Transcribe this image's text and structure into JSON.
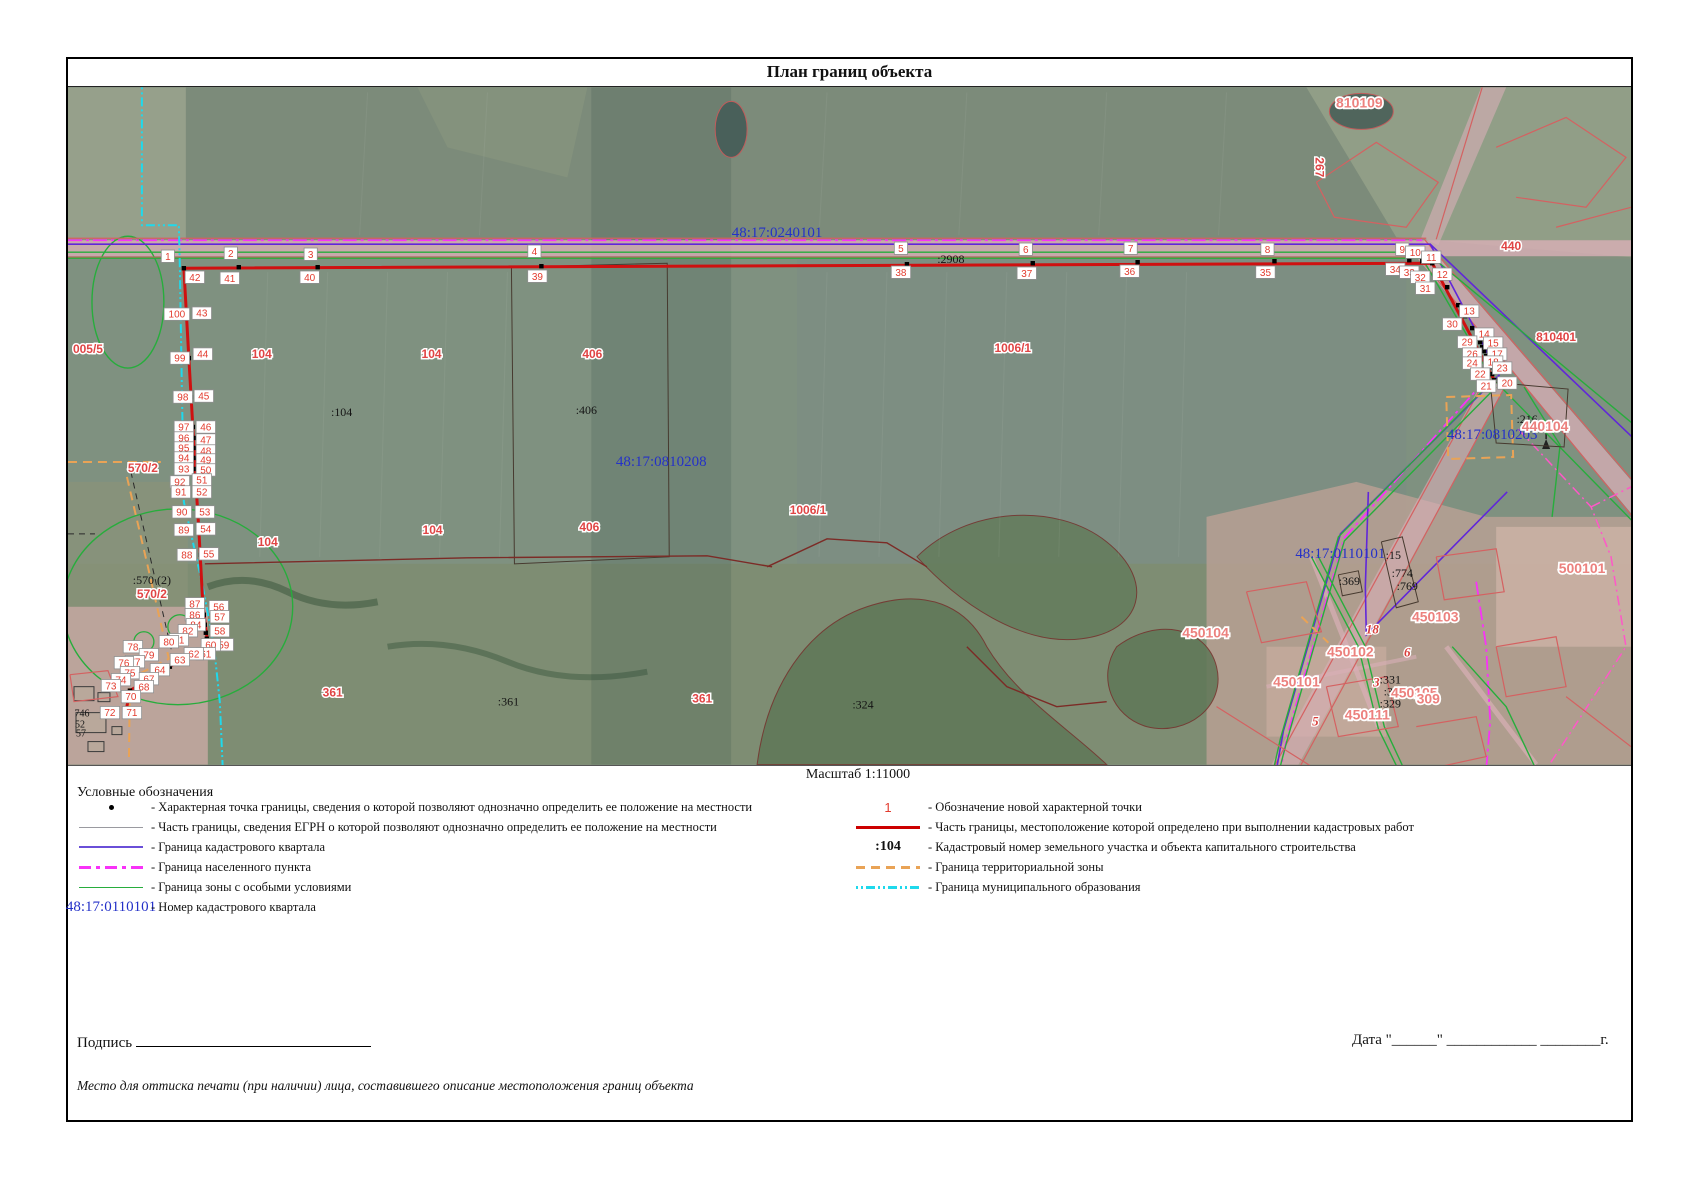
{
  "title": "План границ объекта",
  "scale_label": "Масштаб 1:11000",
  "legend": {
    "heading": "Условные обозначения",
    "left": [
      {
        "symbol": "point",
        "text": "- Характерная точка границы, сведения о которой позволяют однозначно определить ее положение на местности"
      },
      {
        "symbol": "gray",
        "text": "- Часть границы, сведения ЕГРН о которой позволяют однозначно определить ее положение на местности"
      },
      {
        "symbol": "blue",
        "text": "- Граница кадастрового квартала"
      },
      {
        "symbol": "magenta",
        "text": "- Граница населенного пункта"
      },
      {
        "symbol": "green",
        "text": "- Граница зоны с особыми условиями"
      },
      {
        "symbol": "blue-num",
        "symbol_text": "48:17:0110101",
        "text": "- Номер кадастрового квартала"
      }
    ],
    "right": [
      {
        "symbol": "red-num",
        "symbol_text": "1",
        "text": "- Обозначение новой характерной точки"
      },
      {
        "symbol": "red",
        "text": "- Часть границы, местоположение которой определено при выполнении кадастровых работ"
      },
      {
        "symbol": "black-num",
        "symbol_text": ":104",
        "text": "- Кадастровый номер земельного участка и объекта капитального строительства"
      },
      {
        "symbol": "orange",
        "text": "- Граница территориальной зоны"
      },
      {
        "symbol": "cyan",
        "text": "- Граница муниципального образования"
      }
    ]
  },
  "footer": {
    "signature_label": "Подпись",
    "date_label": "Дата \"______\" ____________ ________г.",
    "stamp_note": "Место для оттиска печати (при наличии) лица, составившего описание местоположения границ объекта"
  },
  "colors": {
    "boundary_new_red": "#cf1010",
    "quarter_purple": "#6126d9",
    "settlement_magenta": "#f832f8",
    "special_zone_green": "#27ad3c",
    "municipal_cyan": "#1fd9ec",
    "territorial_orange": "#e9a356",
    "point_label_red": "#e23b2e",
    "cadastral_blue": "#2431c8"
  },
  "map": {
    "quarter_labels": [
      {
        "t": "48:17:0240101",
        "x": 710,
        "y": 150
      },
      {
        "t": "48:17:0810208",
        "x": 594,
        "y": 379
      },
      {
        "t": "48:17:0810203",
        "x": 1426,
        "y": 352
      },
      {
        "t": "48:17:0110101",
        "x": 1274,
        "y": 471
      }
    ],
    "black_labels": [
      {
        "t": ":2908",
        "x": 884,
        "y": 176
      },
      {
        "t": ":104",
        "x": 274,
        "y": 329
      },
      {
        "t": ":406",
        "x": 519,
        "y": 327
      },
      {
        "t": ":570 (2)",
        "x": 84,
        "y": 497
      },
      {
        "t": ":216",
        "x": 1461,
        "y": 336
      },
      {
        "t": ":15",
        "x": 1327,
        "y": 472
      },
      {
        "t": ":774",
        "x": 1336,
        "y": 490
      },
      {
        "t": ":769",
        "x": 1341,
        "y": 503
      },
      {
        "t": ":369",
        "x": 1283,
        "y": 498
      },
      {
        "t": ":331",
        "x": 1324,
        "y": 597
      },
      {
        "t": ":330",
        "x": 1328,
        "y": 609
      },
      {
        "t": ":329",
        "x": 1324,
        "y": 621
      },
      {
        "t": ":361",
        "x": 441,
        "y": 619
      },
      {
        "t": ":324",
        "x": 796,
        "y": 622
      },
      {
        "t": "746",
        "x": 14,
        "y": 630,
        "small": true
      },
      {
        "t": "52",
        "x": 12,
        "y": 641,
        "small": true
      },
      {
        "t": "57",
        "x": 13,
        "y": 650,
        "small": true
      }
    ],
    "red_labels": [
      {
        "t": "005/5",
        "x": 20,
        "y": 266
      },
      {
        "t": "104",
        "x": 194,
        "y": 271
      },
      {
        "t": "104",
        "x": 364,
        "y": 271
      },
      {
        "t": "406",
        "x": 525,
        "y": 271
      },
      {
        "t": "1006/1",
        "x": 946,
        "y": 265
      },
      {
        "t": "570/2",
        "x": 75,
        "y": 385
      },
      {
        "t": "570/2",
        "x": 84,
        "y": 511
      },
      {
        "t": "104",
        "x": 200,
        "y": 459
      },
      {
        "t": "104",
        "x": 365,
        "y": 447
      },
      {
        "t": "406",
        "x": 522,
        "y": 444
      },
      {
        "t": "1006/1",
        "x": 741,
        "y": 427
      },
      {
        "t": "361",
        "x": 265,
        "y": 610
      },
      {
        "t": "361",
        "x": 635,
        "y": 616
      },
      {
        "t": "440",
        "x": 1445,
        "y": 163
      },
      {
        "t": "810401",
        "x": 1490,
        "y": 254
      },
      {
        "t": "267",
        "x": 1249,
        "y": 80,
        "rot": 90
      },
      {
        "t": "810109",
        "x": 1293,
        "y": 20,
        "big": true
      },
      {
        "t": "440104",
        "x": 1479,
        "y": 344,
        "big": true
      },
      {
        "t": "500101",
        "x": 1516,
        "y": 486,
        "big": true
      },
      {
        "t": "450103",
        "x": 1369,
        "y": 535,
        "big": true
      },
      {
        "t": "450102",
        "x": 1284,
        "y": 570,
        "big": true
      },
      {
        "t": "450104",
        "x": 1139,
        "y": 551,
        "big": true
      },
      {
        "t": "450101",
        "x": 1230,
        "y": 600,
        "big": true
      },
      {
        "t": "450105",
        "x": 1348,
        "y": 611,
        "big": true
      },
      {
        "t": "450111",
        "x": 1301,
        "y": 633,
        "big": true
      },
      {
        "t": "309",
        "x": 1362,
        "y": 617,
        "big": true
      }
    ],
    "red_italic": [
      {
        "t": "3",
        "x": 1310,
        "y": 600
      },
      {
        "t": "6",
        "x": 1341,
        "y": 570
      },
      {
        "t": "5",
        "x": 1249,
        "y": 639
      },
      {
        "t": "18",
        "x": 1306,
        "y": 547
      }
    ],
    "lines": [
      {
        "c": "ln-red-thin",
        "p": "0,151 1360,151"
      },
      {
        "c": "ln-red-thin",
        "p": "0,170 1362,170"
      },
      {
        "c": "ln-red-thin",
        "p": "1358,152 1631,468"
      },
      {
        "c": "ln-red-thin",
        "p": "1354,172 1631,508"
      },
      {
        "c": "ln-red-thin",
        "p": "1421,289 1206,683"
      },
      {
        "c": "ln-red-thin",
        "p": "1437,303 1232,683"
      },
      {
        "c": "ln-red-thin",
        "p": "1416,0 1370,152"
      },
      {
        "c": "ln-magenta",
        "p": "0,153 1356,153"
      },
      {
        "c": "ln-magenta",
        "p": "1420,292 1278,451 1221,648 1214,683"
      },
      {
        "c": "ln-magenta",
        "p": "1410,495 1420,560 1424,635 1420,683"
      },
      {
        "c": "ln-purple",
        "p": "0,157 1364,157 1433,288 1274,447 1217,644 1210,683"
      },
      {
        "c": "ln-purple",
        "p": "1364,157 1631,412"
      },
      {
        "c": "ln-purple",
        "p": "1302,405 1299,500 1300,548 1441,405"
      },
      {
        "c": "ln-green",
        "p": "0,165 1360,165 1631,390"
      },
      {
        "c": "ln-green",
        "p": "0,171 1356,171 1425,290 1631,500"
      },
      {
        "c": "ln-green",
        "p": "1424,296 1272,450 1214,652 1207,683"
      },
      {
        "c": "ln-green",
        "p": "1430,300 1278,454 1220,656 1213,683"
      },
      {
        "c": "ln-green",
        "p": "1245,470 1292,560 1312,642 1332,683"
      },
      {
        "c": "ln-green",
        "p": "1251,468 1298,558 1318,640 1338,683"
      },
      {
        "c": "ln-green",
        "p": "1458,300 1494,358 1486,430"
      },
      {
        "c": "ln-green",
        "p": "1386,560 1440,620 1470,683"
      },
      {
        "c": "ln-cyan",
        "p": "74,0 74,138 111,138 112,180 114,300 116,415 134,495 146,558 152,615 155,683"
      },
      {
        "c": "ln-orange",
        "p": "0,375 93,375"
      },
      {
        "c": "ln-orange",
        "p": "59,390 80,480 101,572 62,592 61,675"
      },
      {
        "c": "ln-orange",
        "p": "1380,310 1445,308 1447,370 1382,372 1380,310"
      },
      {
        "c": "ln-orange",
        "p": "1235,530 1262,556"
      },
      {
        "c": "ln-blackdash",
        "p": "63,385 84,478 105,570"
      },
      {
        "c": "ln-blackdash",
        "p": "0,447 27,447"
      },
      {
        "c": "ln-pinkdash",
        "p": "1452,342 1525,420 1545,470 1560,560 1505,645 1480,683"
      },
      {
        "c": "ln-pinkdash",
        "p": "1525,420 1565,400 1631,430"
      },
      {
        "c": "ln-dark",
        "p": "444,180 600,176 602,470 447,477 444,180"
      },
      {
        "c": "ln-dark",
        "p": "1315,455 1336,450 1352,515 1330,521 1315,455"
      },
      {
        "c": "ln-dark",
        "p": "1272,488 1292,484 1296,505 1276,509 1272,488"
      },
      {
        "c": "ln-dark",
        "p": "1424,295 1502,302 1498,360 1430,356 1424,295"
      },
      {
        "c": "ln-darkred",
        "p": "137,477 400,471 640,469 705,480"
      },
      {
        "c": "ln-darkred",
        "p": "700,480 760,452 820,456 860,480"
      },
      {
        "c": "ln-darkred",
        "p": "900,560 940,600 990,620 1040,615"
      },
      {
        "c": "ln-red-thin",
        "p": "1250,95 1310,55 1372,95 1340,140 1268,130 1250,95"
      },
      {
        "c": "ln-red-thin",
        "p": "1430,60 1500,30 1560,70 1520,120 1450,110"
      },
      {
        "c": "ln-red-thin",
        "p": "1490,140 1565,120"
      },
      {
        "c": "ln-red-thin",
        "p": "1180,505 1240,495 1255,545 1195,556 1180,505"
      },
      {
        "c": "ln-red-thin",
        "p": "1260,600 1320,590 1332,640 1272,650 1260,600"
      },
      {
        "c": "ln-red-thin",
        "p": "1350,640 1410,630 1420,670 1360,683"
      },
      {
        "c": "ln-red-thin",
        "p": "1430,560 1490,550 1500,600 1440,610 1430,560"
      },
      {
        "c": "ln-red-thin",
        "p": "1370,470 1430,462 1438,505 1378,513 1370,470"
      },
      {
        "c": "ln-red-thin",
        "p": "1150,620 1250,683"
      },
      {
        "c": "ln-red-thin",
        "p": "1500,610 1565,660"
      },
      {
        "c": "ln-red-thin",
        "p": "2,588 40,584 50,610 6,615 2,588"
      },
      {
        "c": "ln-red-main",
        "p": "116,181 1366,176 1428,293"
      },
      {
        "c": "ln-red-main",
        "p": "116,181 121,271 125,340 128,395 131,443 135,517 140,558 93,585 62,604 58,625"
      }
    ],
    "dots": [
      [
        116,
        181
      ],
      [
        171,
        180
      ],
      [
        250,
        180
      ],
      [
        474,
        179
      ],
      [
        840,
        177
      ],
      [
        966,
        176
      ],
      [
        1071,
        175
      ],
      [
        1208,
        174
      ],
      [
        1343,
        173
      ],
      [
        1356,
        174
      ],
      [
        1366,
        176
      ],
      [
        1372,
        186
      ],
      [
        1381,
        200
      ],
      [
        1392,
        218
      ],
      [
        1399,
        229
      ],
      [
        1406,
        241
      ],
      [
        1411,
        250
      ],
      [
        1414,
        255
      ],
      [
        1416,
        260
      ],
      [
        1418,
        264
      ],
      [
        1420,
        269
      ],
      [
        1422,
        274
      ],
      [
        1424,
        280
      ],
      [
        1426,
        287
      ],
      [
        1428,
        293
      ],
      [
        119,
        227
      ],
      [
        121,
        271
      ],
      [
        123,
        310
      ],
      [
        125,
        340
      ],
      [
        126,
        351
      ],
      [
        126,
        361
      ],
      [
        127,
        371
      ],
      [
        127,
        382
      ],
      [
        128,
        395
      ],
      [
        128,
        405
      ],
      [
        130,
        425
      ],
      [
        131,
        443
      ],
      [
        133,
        468
      ],
      [
        135,
        517
      ],
      [
        136,
        528
      ],
      [
        137,
        538
      ],
      [
        138,
        546
      ],
      [
        139,
        552
      ],
      [
        140,
        558
      ],
      [
        131,
        563
      ],
      [
        121,
        569
      ],
      [
        112,
        574
      ],
      [
        102,
        580
      ],
      [
        93,
        585
      ],
      [
        86,
        590
      ],
      [
        80,
        595
      ],
      [
        73,
        599
      ],
      [
        62,
        604
      ],
      [
        59,
        612
      ],
      [
        58,
        625
      ]
    ],
    "points": [
      {
        "n": "1",
        "x": 100,
        "y": 169
      },
      {
        "n": "2",
        "x": 163,
        "y": 166
      },
      {
        "n": "3",
        "x": 243,
        "y": 167
      },
      {
        "n": "4",
        "x": 467,
        "y": 164
      },
      {
        "n": "5",
        "x": 834,
        "y": 161
      },
      {
        "n": "6",
        "x": 959,
        "y": 162
      },
      {
        "n": "7",
        "x": 1064,
        "y": 161
      },
      {
        "n": "8",
        "x": 1201,
        "y": 162
      },
      {
        "n": "9",
        "x": 1336,
        "y": 162
      },
      {
        "n": "10",
        "x": 1349,
        "y": 165
      },
      {
        "n": "11",
        "x": 1365,
        "y": 170
      },
      {
        "n": "42",
        "x": 127,
        "y": 190
      },
      {
        "n": "41",
        "x": 162,
        "y": 191
      },
      {
        "n": "40",
        "x": 242,
        "y": 190
      },
      {
        "n": "39",
        "x": 470,
        "y": 189
      },
      {
        "n": "38",
        "x": 834,
        "y": 185
      },
      {
        "n": "37",
        "x": 960,
        "y": 186
      },
      {
        "n": "36",
        "x": 1063,
        "y": 184
      },
      {
        "n": "35",
        "x": 1199,
        "y": 185
      },
      {
        "n": "34",
        "x": 1329,
        "y": 182
      },
      {
        "n": "33",
        "x": 1343,
        "y": 185
      },
      {
        "n": "32",
        "x": 1354,
        "y": 190
      },
      {
        "n": "31",
        "x": 1359,
        "y": 201
      },
      {
        "n": "12",
        "x": 1376,
        "y": 187
      },
      {
        "n": "13",
        "x": 1403,
        "y": 224
      },
      {
        "n": "30",
        "x": 1386,
        "y": 237
      },
      {
        "n": "14",
        "x": 1418,
        "y": 247
      },
      {
        "n": "29",
        "x": 1401,
        "y": 255
      },
      {
        "n": "15",
        "x": 1427,
        "y": 256
      },
      {
        "n": "26",
        "x": 1406,
        "y": 267
      },
      {
        "n": "17",
        "x": 1431,
        "y": 267
      },
      {
        "n": "24",
        "x": 1406,
        "y": 276
      },
      {
        "n": "18",
        "x": 1427,
        "y": 275
      },
      {
        "n": "23",
        "x": 1436,
        "y": 281
      },
      {
        "n": "22",
        "x": 1414,
        "y": 287
      },
      {
        "n": "21",
        "x": 1420,
        "y": 299
      },
      {
        "n": "20",
        "x": 1441,
        "y": 296
      },
      {
        "n": "100",
        "x": 109,
        "y": 227
      },
      {
        "n": "43",
        "x": 134,
        "y": 226
      },
      {
        "n": "99",
        "x": 112,
        "y": 271
      },
      {
        "n": "44",
        "x": 135,
        "y": 267
      },
      {
        "n": "98",
        "x": 115,
        "y": 310
      },
      {
        "n": "45",
        "x": 136,
        "y": 309
      },
      {
        "n": "97",
        "x": 116,
        "y": 340
      },
      {
        "n": "46",
        "x": 138,
        "y": 340
      },
      {
        "n": "96",
        "x": 116,
        "y": 351
      },
      {
        "n": "47",
        "x": 138,
        "y": 353
      },
      {
        "n": "95",
        "x": 116,
        "y": 361
      },
      {
        "n": "48",
        "x": 138,
        "y": 364
      },
      {
        "n": "94",
        "x": 116,
        "y": 371
      },
      {
        "n": "49",
        "x": 138,
        "y": 373
      },
      {
        "n": "93",
        "x": 116,
        "y": 382
      },
      {
        "n": "50",
        "x": 138,
        "y": 383
      },
      {
        "n": "92",
        "x": 112,
        "y": 395
      },
      {
        "n": "51",
        "x": 134,
        "y": 393
      },
      {
        "n": "91",
        "x": 113,
        "y": 405
      },
      {
        "n": "52",
        "x": 134,
        "y": 405
      },
      {
        "n": "90",
        "x": 114,
        "y": 425
      },
      {
        "n": "53",
        "x": 137,
        "y": 425
      },
      {
        "n": "89",
        "x": 116,
        "y": 443
      },
      {
        "n": "54",
        "x": 138,
        "y": 442
      },
      {
        "n": "88",
        "x": 119,
        "y": 468
      },
      {
        "n": "55",
        "x": 141,
        "y": 467
      },
      {
        "n": "87",
        "x": 127,
        "y": 517
      },
      {
        "n": "56",
        "x": 151,
        "y": 520
      },
      {
        "n": "86",
        "x": 127,
        "y": 528
      },
      {
        "n": "57",
        "x": 152,
        "y": 530
      },
      {
        "n": "84",
        "x": 128,
        "y": 538
      },
      {
        "n": "58",
        "x": 152,
        "y": 544
      },
      {
        "n": "82",
        "x": 120,
        "y": 544
      },
      {
        "n": "59",
        "x": 156,
        "y": 558
      },
      {
        "n": "81",
        "x": 111,
        "y": 553
      },
      {
        "n": "60",
        "x": 143,
        "y": 558
      },
      {
        "n": "80",
        "x": 101,
        "y": 555
      },
      {
        "n": "61",
        "x": 138,
        "y": 567
      },
      {
        "n": "62",
        "x": 126,
        "y": 567
      },
      {
        "n": "63",
        "x": 112,
        "y": 573
      },
      {
        "n": "78",
        "x": 65,
        "y": 560
      },
      {
        "n": "79",
        "x": 81,
        "y": 568
      },
      {
        "n": "77",
        "x": 67,
        "y": 575
      },
      {
        "n": "76",
        "x": 56,
        "y": 576
      },
      {
        "n": "75",
        "x": 62,
        "y": 586
      },
      {
        "n": "74",
        "x": 53,
        "y": 593
      },
      {
        "n": "73",
        "x": 43,
        "y": 599
      },
      {
        "n": "64",
        "x": 92,
        "y": 583
      },
      {
        "n": "67",
        "x": 81,
        "y": 592
      },
      {
        "n": "68",
        "x": 76,
        "y": 600
      },
      {
        "n": "70",
        "x": 63,
        "y": 610
      },
      {
        "n": "72",
        "x": 42,
        "y": 626
      },
      {
        "n": "71",
        "x": 64,
        "y": 626
      }
    ]
  }
}
